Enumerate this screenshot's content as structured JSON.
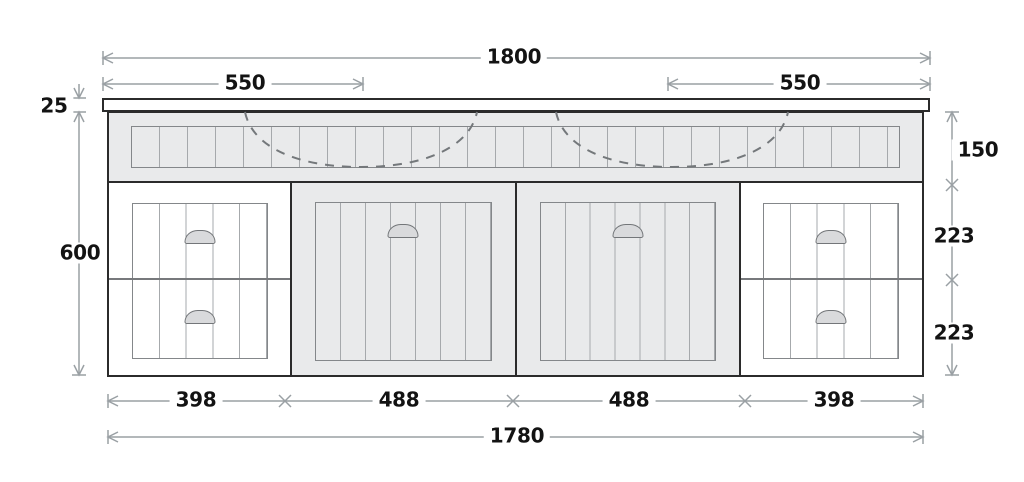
{
  "dimensions": {
    "overall_top_width": "1800",
    "basin_left_offset": "550",
    "basin_right_offset": "550",
    "benchtop_thickness": "25",
    "cabinet_height": "600",
    "apron_height": "150",
    "top_drawer_height": "223",
    "bottom_drawer_height": "223",
    "bottom_segments": [
      "398",
      "488",
      "488",
      "398"
    ],
    "cabinet_width": "1780"
  },
  "colors": {
    "ink": "#2b2b2b",
    "dim": "#9aa0a4",
    "dash": "#74787b",
    "fill_gray": "#e9eaeb",
    "fill_white": "#ffffff",
    "panel_border": "#84878a",
    "panel_line": "#a6a9ac",
    "handle_fill": "#d9dadc",
    "label_ink": "#131313",
    "page_bg": "#ffffff"
  }
}
